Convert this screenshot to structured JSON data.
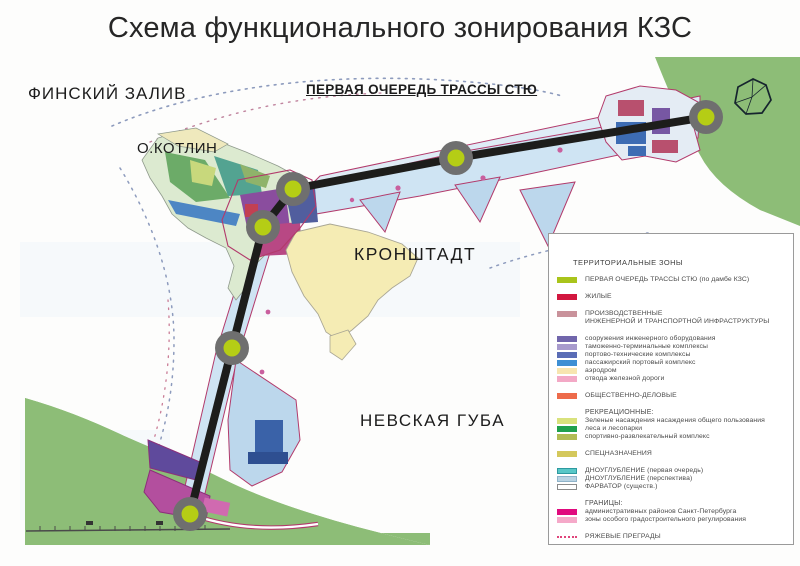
{
  "title": "Схема функционального зонирования КЗС",
  "map_labels": {
    "gulf": "ФИНСКИЙ ЗАЛИВ",
    "kotlin_island": "О.КОТЛИН",
    "route_first_stage": "ПЕРВАЯ ОЧЕРЕДЬ ТРАССЫ СТЮ",
    "kronstadt": "КРОНШТАДТ",
    "neva_bay": "НЕВСКАЯ ГУБА"
  },
  "colors": {
    "route": "#1d1d1b",
    "node_ring": "#6f6f6f",
    "node_core": "#b5cd15",
    "land_green": "#8dbd77",
    "dredge_first": "#cfe4f3",
    "dredge_perspective": "#bcd7ec",
    "zone_boundary_pink": "#b23a6b",
    "kronstadt_fill": "#f5ecb4"
  },
  "legend": {
    "title": "ТЕРРИТОРИАЛЬНЫЕ ЗОНЫ",
    "groups": [
      {
        "items": [
          {
            "color": "#a9c41b",
            "label": "ПЕРВАЯ ОЧЕРЕДЬ ТРАССЫ СТЮ (по дамбе КЗС)"
          }
        ]
      },
      {
        "items": [
          {
            "color": "#d2173f",
            "label": "ЖИЛЫЕ"
          }
        ]
      },
      {
        "items": [
          {
            "color": "#c9929b",
            "label": "ПРОИЗВОДСТВЕННЫЕ",
            "label2": "ИНЖЕНЕРНОЙ И ТРАНСПОРТНОЙ ИНФРАСТРУКТУРЫ"
          }
        ]
      },
      {
        "items": [
          {
            "color": "#7166ac",
            "label": "сооружения инженерного оборудования"
          },
          {
            "color": "#a89bcd",
            "label": "таможенно-терминальные комплексы"
          },
          {
            "color": "#5a6db6",
            "label": "портово-технические комплексы"
          },
          {
            "color": "#3e8fd4",
            "label": "пассажирский портовый комплекс"
          },
          {
            "color": "#f7e5b0",
            "label": "аэродром"
          },
          {
            "color": "#f3a9c6",
            "label": "отвода железной дороги"
          }
        ]
      },
      {
        "items": [
          {
            "color": "#ed6b4b",
            "label": "ОБЩЕСТВЕННО-ДЕЛОВЫЕ"
          }
        ]
      },
      {
        "header": "РЕКРЕАЦИОННЫЕ:",
        "items": [
          {
            "color": "#d9e27d",
            "label": "Зеленые насаждения насаждения общего пользования"
          },
          {
            "color": "#1fa04c",
            "label": "леса и лесопарки"
          },
          {
            "color": "#b1bc55",
            "label": "спортивно-развлекательный комплекс"
          }
        ]
      },
      {
        "items": [
          {
            "color": "#d4c85c",
            "label": "СПЕЦНАЗНАЧЕНИЯ"
          }
        ]
      },
      {
        "items": [
          {
            "color": "#58c7c7",
            "border": "#2e9aa0",
            "label": "ДНОУГЛУБЛЕНИЕ (первая очередь)"
          },
          {
            "color": "#b9d3e3",
            "border": "#8fb3c9",
            "label": "ДНОУГЛУБЛЕНИЕ (перспектива)"
          },
          {
            "color": "#ffffff",
            "border": "#8a8a8a",
            "label": "ФАРВАТОР (существ.)"
          }
        ]
      },
      {
        "header": "ГРАНИЦЫ:",
        "items": [
          {
            "color": "#e00a7e",
            "label": "административных районов Санкт-Петербурга"
          },
          {
            "color": "#f5a9c9",
            "label": "зоны особого градостроительного регулирования"
          }
        ]
      },
      {
        "items": [
          {
            "type": "dotted",
            "color": "#e0457b",
            "label": "РЯЖЕВЫЕ ПРЕГРАДЫ"
          }
        ]
      }
    ]
  }
}
